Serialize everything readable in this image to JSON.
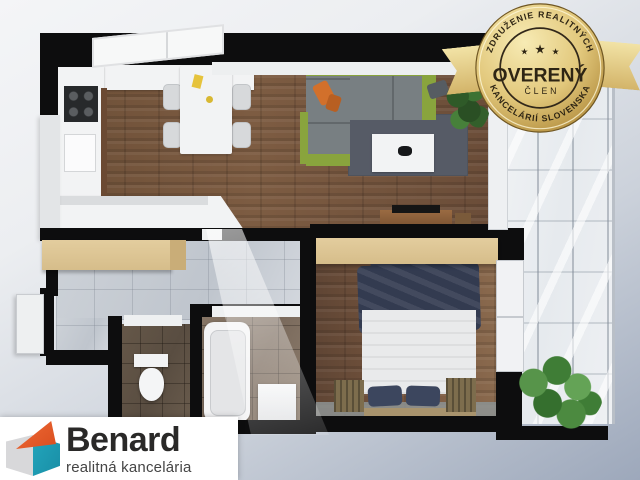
{
  "badge": {
    "arc_top": "ZDRUŽENIE REALITNÝCH",
    "title": "OVERENÝ",
    "member": "ČLEN",
    "arc_bottom": "KANCELÁRIÍ SLOVENSKA",
    "star": "★",
    "colors": {
      "gold_light": "#f6e8ae",
      "gold_mid": "#dcbf70",
      "gold_dark": "#b08a3a",
      "text": "#2e2514",
      "ribbon_light": "#f2e3a6",
      "ribbon_dark": "#d3b469"
    }
  },
  "logo": {
    "brand": "Benard",
    "tagline": "realitná kancelária",
    "colors": {
      "orange": "#e55b2c",
      "teal": "#1d9db4",
      "gray": "#d8d8da",
      "text": "#2a2928",
      "tagline_text": "#454545",
      "background": "#ffffff"
    }
  },
  "floorplan": {
    "description": "3D top-down apartment floor plan render",
    "colors": {
      "background_top": "#f2f3f5",
      "background_bottom": "#9da8bb",
      "wall": "#0d0d0e",
      "wall_light": "#e3e5e7",
      "wood_floor": "#74553f",
      "hall_tile": "#c6cbd2",
      "bath_tile": "#7c6c5e",
      "wc_tile": "#61544a",
      "wardrobe": "#dcc496",
      "sofa_green": "#89a43d",
      "sofa_gray": "#787f82",
      "rug": "#565b66",
      "bed_duvet": "#333b50",
      "bed_sheet": "#e9eaeb",
      "plant": "#3f7d36",
      "counter": "#f2f3f4",
      "accent_pillow": "#d2702b"
    }
  }
}
